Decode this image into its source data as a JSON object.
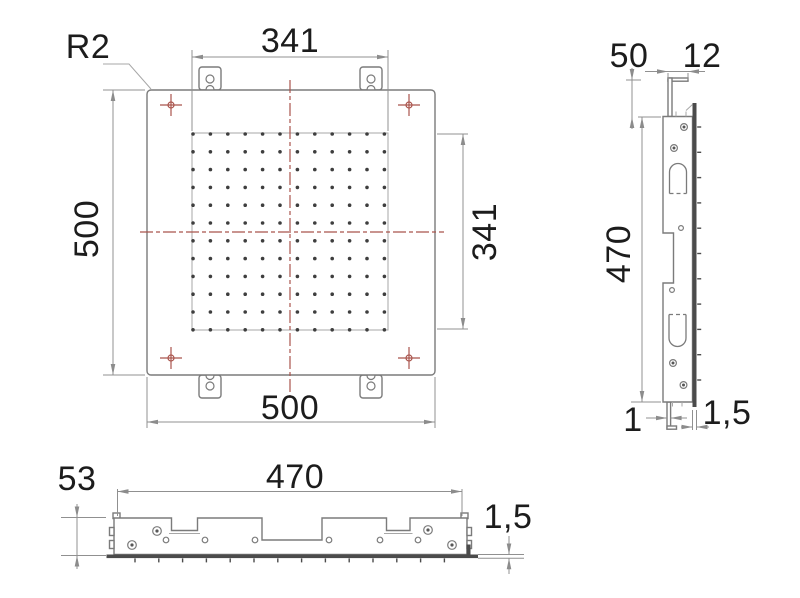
{
  "drawing_title": "Square rain shower head - dimensional drawing",
  "colors": {
    "outline": "#7b7b7b",
    "dark_plate": "#4b4b4b",
    "dimension": "#909090",
    "centerline_red": "#a9544c",
    "text": "#1c1c1c",
    "nozzle": "#3e3e3e"
  },
  "front_view": {
    "corner_radius_label": "R2",
    "dim_nozzle_width_top": "341",
    "dim_plate_height_left": "500",
    "dim_plate_width_bottom": "500",
    "dim_nozzle_height_right": "341",
    "nozzle_grid": {
      "cols": 12,
      "rows": 12,
      "x0": 193,
      "y0": 134,
      "dx": 17.4,
      "dy": 17.8,
      "r": 1.8
    }
  },
  "side_view": {
    "dim_bracket_height": "50",
    "dim_bracket_hook": "12",
    "dim_body_height": "470",
    "dim_tab_thickness": "1",
    "dim_face_thickness": "1,5",
    "nozzle_ticks": {
      "count": 11,
      "x": 697.2,
      "y0": 127,
      "dy": 25.3,
      "len": 4
    }
  },
  "bottom_view": {
    "dim_body_height": "53",
    "dim_body_width": "470",
    "dim_face_thickness": "1,5",
    "nozzle_ticks": {
      "count": 14,
      "y": 558.4,
      "x0": 135,
      "dx": 23.8,
      "len": 4
    }
  }
}
